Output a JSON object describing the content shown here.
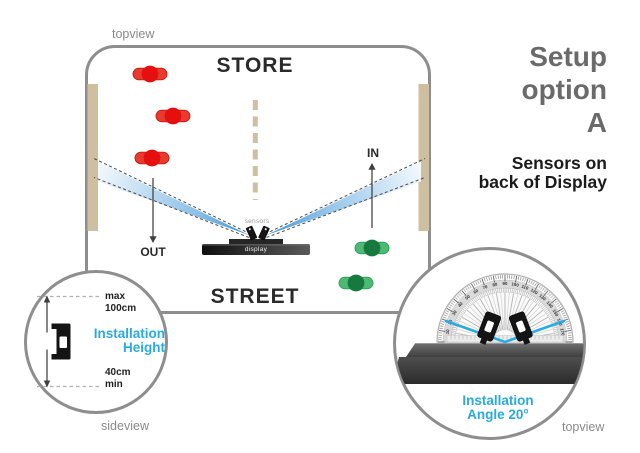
{
  "colors": {
    "accent_cyan": "#29abe2",
    "outline_gray": "#8e8e8e",
    "title_gray": "#6a6a6a",
    "muted_gray": "#8a8a8a",
    "wall_tan": "#cdbf9f",
    "beam_blue": "#4d9fd6",
    "red_body": "#e73b30",
    "red_head": "#e60f0f",
    "green_body": "#4db974",
    "green_head": "#17793f"
  },
  "main_panel": {
    "view_label": "topview",
    "store_label": "STORE",
    "street_label": "STREET",
    "in_label": "IN",
    "out_label": "OUT",
    "sensors_label": "sensors",
    "display_label": "display",
    "people_out": [
      [
        150,
        74
      ],
      [
        173,
        116
      ],
      [
        152,
        158
      ]
    ],
    "people_in": [
      [
        372,
        248
      ],
      [
        356,
        283
      ]
    ]
  },
  "side_text": {
    "title_line1": "Setup",
    "title_line2": "option",
    "title_line3": "A",
    "subtitle_line1": "Sensors on",
    "subtitle_line2": "back of Display"
  },
  "height_detail": {
    "max_label": "max",
    "max_value": "100cm",
    "caption_line1": "Installation",
    "caption_line2": "Height",
    "min_value": "40cm",
    "min_label": "min",
    "view_label": "sideview"
  },
  "angle_detail": {
    "caption_line1": "Installation",
    "caption_line2": "Angle 20°",
    "view_label": "topview",
    "protractor_numbers": [
      10,
      20,
      30,
      40,
      50,
      60,
      70,
      80,
      90,
      100,
      110,
      120,
      130,
      140,
      150,
      160,
      170
    ]
  }
}
